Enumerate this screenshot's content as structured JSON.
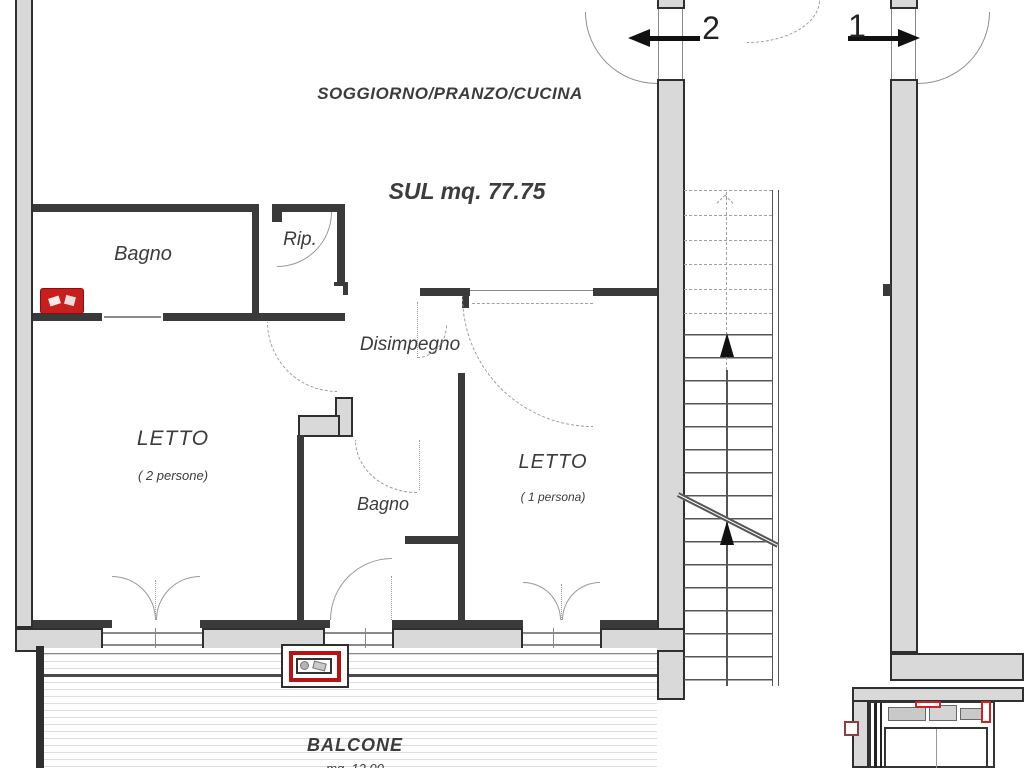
{
  "plan": {
    "living_label": "SOGGIORNO/PRANZO/CUCINA",
    "area_label": "SUL mq. 77.75",
    "bath1_label": "Bagno",
    "storage_label": "Rip.",
    "hall_label": "Disimpegno",
    "bed2_label": "LETTO",
    "bed2_capacity": "( 2 persone)",
    "bath2_label": "Bagno",
    "bed1_label": "LETTO",
    "bed1_capacity": "( 1 persona)",
    "balcony_label": "BALCONE",
    "balcony_area": "mq. 12.00",
    "door1_label": "1",
    "door2_label": "2",
    "dimensions": [
      "2.30",
      "1.00",
      "1.30",
      "0.60",
      "1.00",
      "2.30"
    ],
    "colors": {
      "accent_red": "#b51212",
      "wall_fill": "#d9d9d9",
      "line": "#2f2f2f"
    }
  }
}
